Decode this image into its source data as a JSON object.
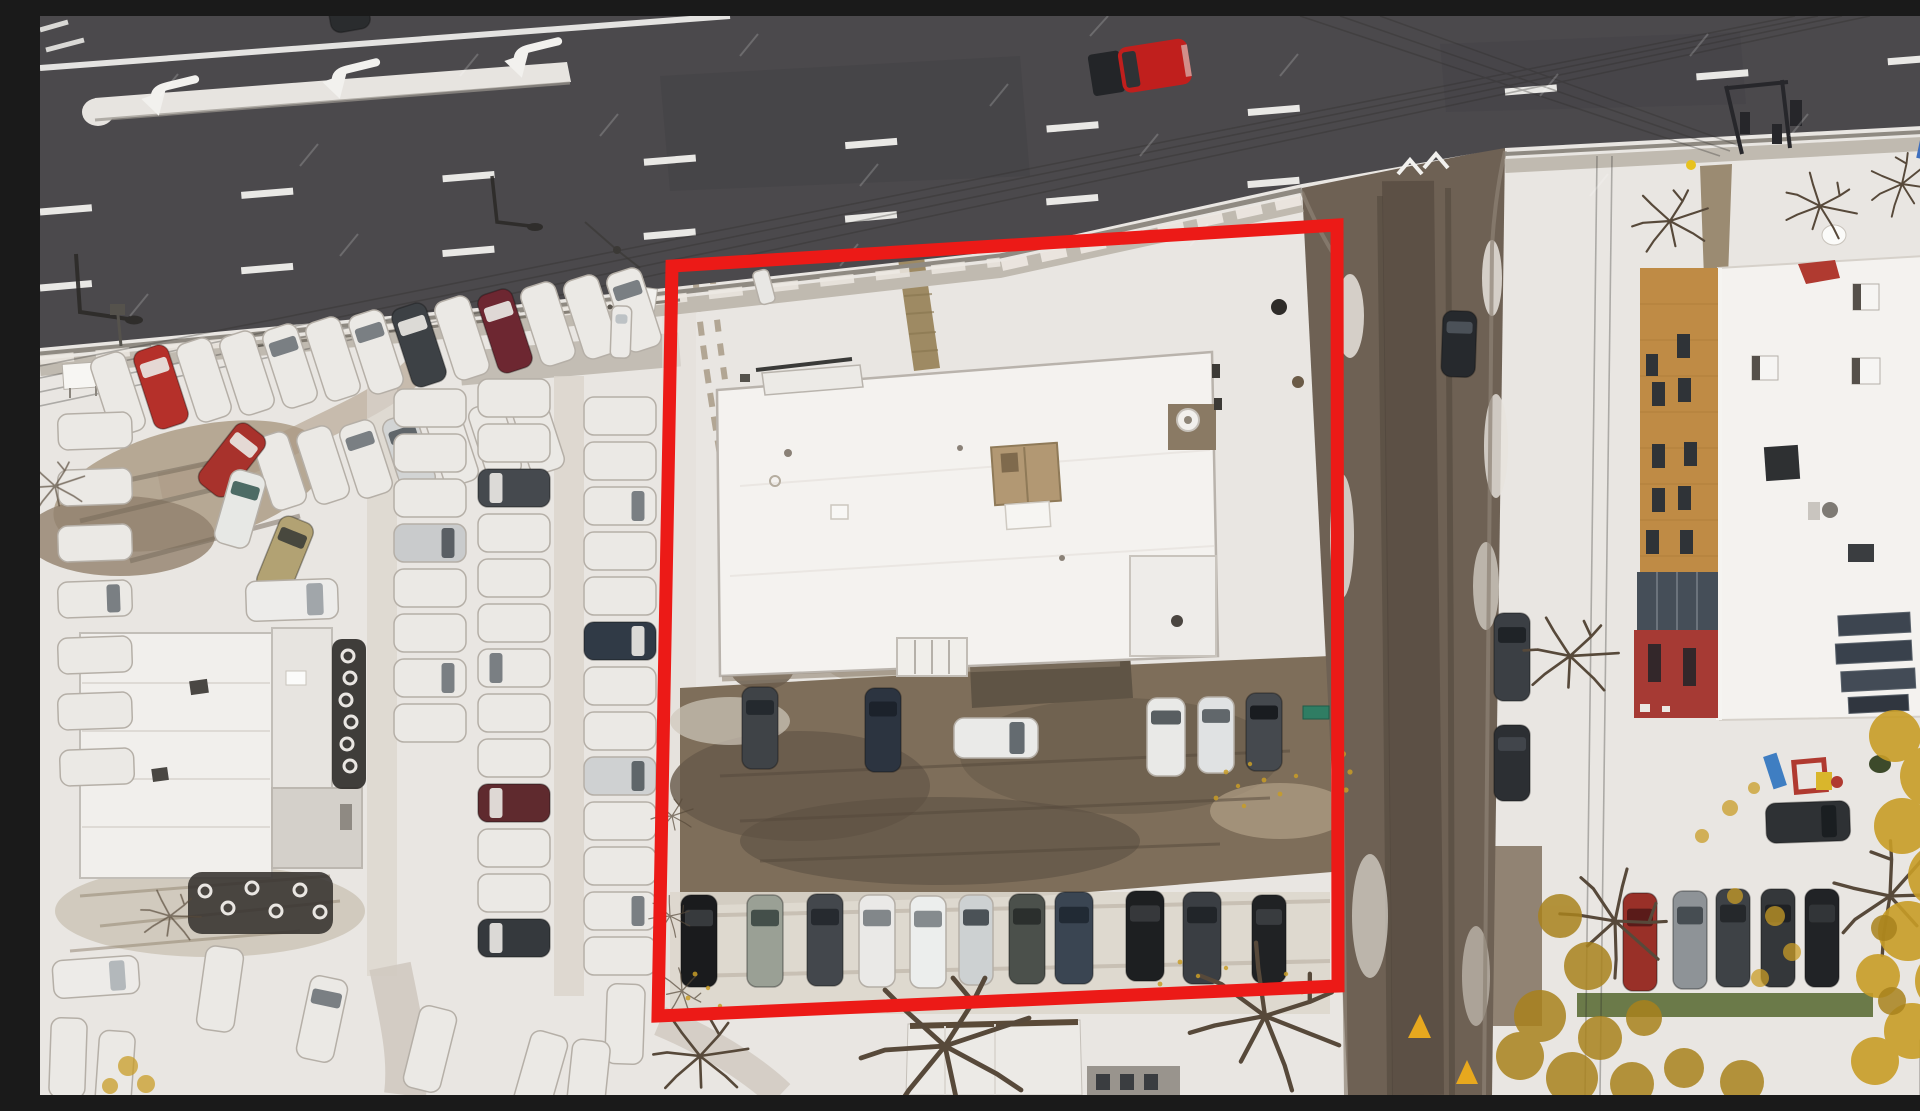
{
  "scene": {
    "description": "Aerial drone photograph, looking straight down, of a snow-dusted commercial parcel outlined with a thick red property boundary. A multi-lane road with white lane dashes and three left-turn arrows runs along the top, a wet brown side street runs down the right of the parcel, a car dealership lot full of snow-covered cars fills the left side, and an apartment building with a wooden and red facade, rooftop equipment and a small playground sits at the right. Autumn trees with yellow leaves surround the lower right.",
    "season": "early winter, fresh snow over autumn leaves",
    "camera": "top-down drone view"
  },
  "palette": {
    "snow": "#e9e6e2",
    "snow_bright": "#f4f2ee",
    "snow_trampled": "#cfc8bf",
    "sidewalk": "#c0bab0",
    "asphalt": "#4b494c",
    "asphalt_dark": "#434146",
    "side_road": "#6e6154",
    "wet_track": "#594e43",
    "mud": "#7e6e5a",
    "mud_dark": "#635647",
    "roof_snow": "#f4f2ef",
    "roof_line": "#b9b3ac",
    "left_roof": "#f1efec",
    "tan_unit": "#b29873",
    "tan_facade": "#bf8b45",
    "red_facade": "#a63a34",
    "glass": "#454e58",
    "boundary": "#ec1a17",
    "leaf": "#c89d27",
    "leaf_dark": "#a8821d",
    "grass": "#6b7a49",
    "tree": "#57493a",
    "line_white": "#f2f1ee",
    "car_snow": "#ebe9e5"
  },
  "boundary": {
    "purpose": "highlighted property parcel",
    "color": "#ec1a17",
    "stroke_width": 13,
    "corners": [
      [
        632,
        250
      ],
      [
        1297,
        209
      ],
      [
        1298,
        970
      ],
      [
        618,
        1000
      ]
    ]
  },
  "road_markings": {
    "turn_arrow_count": 3,
    "lane_dash_rows": 2,
    "give_way_chevrons": 2,
    "yellow_triangles": 2
  },
  "vehicles": {
    "count_estimate": 97,
    "note": "[cx, cy, rotation_deg, width, length, body_color, window_color] — SNOW = snow-covered car",
    "list": [
      [
        78,
        378,
        -18,
        36,
        82,
        "SNOW",
        ""
      ],
      [
        121,
        371,
        -18,
        36,
        82,
        "#b5302a",
        "#e9e7e3"
      ],
      [
        164,
        364,
        -18,
        36,
        82,
        "SNOW",
        ""
      ],
      [
        207,
        357,
        -18,
        36,
        82,
        "SNOW",
        ""
      ],
      [
        250,
        350,
        -18,
        36,
        82,
        "SNOW",
        "#70757b"
      ],
      [
        293,
        343,
        -18,
        36,
        82,
        "SNOW",
        ""
      ],
      [
        336,
        336,
        -18,
        36,
        82,
        "SNOW",
        "#70757b"
      ],
      [
        379,
        329,
        -18,
        36,
        82,
        "#3d4145",
        "#e9e7e3"
      ],
      [
        422,
        322,
        -18,
        36,
        82,
        "SNOW",
        ""
      ],
      [
        465,
        315,
        -18,
        36,
        82,
        "#6d2731",
        "#e9e7e3"
      ],
      [
        508,
        308,
        -18,
        36,
        82,
        "SNOW",
        ""
      ],
      [
        551,
        301,
        -18,
        36,
        82,
        "SNOW",
        ""
      ],
      [
        594,
        294,
        -18,
        36,
        82,
        "SNOW",
        "#70757b"
      ],
      [
        240,
        455,
        -18,
        36,
        76,
        "SNOW",
        ""
      ],
      [
        283,
        449,
        -18,
        36,
        76,
        "SNOW",
        ""
      ],
      [
        326,
        443,
        -18,
        36,
        76,
        "SNOW",
        "#70757b"
      ],
      [
        369,
        437,
        -18,
        36,
        76,
        "#d2d4d4",
        "#565c61"
      ],
      [
        412,
        431,
        -18,
        36,
        76,
        "SNOW",
        ""
      ],
      [
        455,
        425,
        -18,
        36,
        76,
        "SNOW",
        ""
      ],
      [
        498,
        419,
        -18,
        36,
        76,
        "SNOW",
        ""
      ],
      [
        55,
        415,
        88,
        36,
        74,
        "SNOW",
        ""
      ],
      [
        55,
        471,
        88,
        36,
        74,
        "SNOW",
        ""
      ],
      [
        55,
        527,
        88,
        36,
        74,
        "SNOW",
        ""
      ],
      [
        55,
        583,
        88,
        36,
        74,
        "SNOW",
        "#70757b"
      ],
      [
        55,
        639,
        88,
        36,
        74,
        "SNOW",
        ""
      ],
      [
        55,
        695,
        88,
        36,
        74,
        "SNOW",
        ""
      ],
      [
        57,
        751,
        88,
        36,
        74,
        "SNOW",
        ""
      ],
      [
        390,
        392,
        90,
        38,
        72,
        "SNOW",
        ""
      ],
      [
        390,
        437,
        90,
        38,
        72,
        "SNOW",
        ""
      ],
      [
        390,
        482,
        90,
        38,
        72,
        "SNOW",
        ""
      ],
      [
        390,
        527,
        90,
        38,
        72,
        "#c9cbcc",
        "#50565b"
      ],
      [
        390,
        572,
        90,
        38,
        72,
        "SNOW",
        ""
      ],
      [
        390,
        617,
        90,
        38,
        72,
        "SNOW",
        ""
      ],
      [
        390,
        662,
        90,
        38,
        72,
        "SNOW",
        "#70757b"
      ],
      [
        390,
        707,
        90,
        38,
        72,
        "SNOW",
        ""
      ],
      [
        474,
        382,
        -90,
        38,
        72,
        "SNOW",
        ""
      ],
      [
        474,
        427,
        -90,
        38,
        72,
        "SNOW",
        ""
      ],
      [
        474,
        472,
        -90,
        38,
        72,
        "#45494e",
        "#e9e7e3"
      ],
      [
        474,
        517,
        -90,
        38,
        72,
        "SNOW",
        ""
      ],
      [
        474,
        562,
        -90,
        38,
        72,
        "SNOW",
        ""
      ],
      [
        474,
        607,
        -90,
        38,
        72,
        "SNOW",
        ""
      ],
      [
        474,
        652,
        -90,
        38,
        72,
        "SNOW",
        "#70757b"
      ],
      [
        474,
        697,
        -90,
        38,
        72,
        "SNOW",
        ""
      ],
      [
        474,
        742,
        -90,
        38,
        72,
        "SNOW",
        ""
      ],
      [
        474,
        787,
        -90,
        38,
        72,
        "#5f2a2e",
        "#e9e7e3"
      ],
      [
        474,
        832,
        -90,
        38,
        72,
        "SNOW",
        ""
      ],
      [
        474,
        877,
        -90,
        38,
        72,
        "SNOW",
        ""
      ],
      [
        474,
        922,
        -90,
        38,
        72,
        "#35393d",
        "#e9e7e3"
      ],
      [
        580,
        400,
        90,
        38,
        72,
        "SNOW",
        ""
      ],
      [
        580,
        445,
        90,
        38,
        72,
        "SNOW",
        ""
      ],
      [
        580,
        490,
        90,
        38,
        72,
        "SNOW",
        "#70757b"
      ],
      [
        580,
        535,
        90,
        38,
        72,
        "SNOW",
        ""
      ],
      [
        580,
        580,
        90,
        38,
        72,
        "SNOW",
        ""
      ],
      [
        580,
        625,
        90,
        38,
        72,
        "#303a46",
        "#e9e7e3"
      ],
      [
        580,
        670,
        90,
        38,
        72,
        "SNOW",
        ""
      ],
      [
        580,
        715,
        90,
        38,
        72,
        "SNOW",
        ""
      ],
      [
        580,
        760,
        90,
        38,
        72,
        "#cfd1d2",
        "#565c61"
      ],
      [
        580,
        805,
        90,
        38,
        72,
        "SNOW",
        ""
      ],
      [
        580,
        850,
        90,
        38,
        72,
        "SNOW",
        ""
      ],
      [
        580,
        895,
        90,
        38,
        72,
        "SNOW",
        "#70757b"
      ],
      [
        580,
        940,
        90,
        38,
        72,
        "SNOW",
        ""
      ],
      [
        192,
        444,
        38,
        36,
        76,
        "#a8322c",
        "#e9e7e3"
      ],
      [
        200,
        493,
        16,
        36,
        76,
        "#e7e8e5",
        "#40605a"
      ],
      [
        245,
        540,
        22,
        36,
        78,
        "#b2a273",
        "#3f4039"
      ],
      [
        252,
        584,
        88,
        40,
        92,
        "#edecea",
        "#9aa0a4"
      ],
      [
        56,
        961,
        86,
        38,
        86,
        "#edebe8",
        "#aeb3b6"
      ],
      [
        180,
        973,
        8,
        38,
        84,
        "SNOW",
        ""
      ],
      [
        282,
        1003,
        12,
        38,
        84,
        "SNOW",
        "#70757b"
      ],
      [
        390,
        1033,
        14,
        38,
        84,
        "SNOW",
        ""
      ],
      [
        500,
        1058,
        16,
        38,
        84,
        "SNOW",
        ""
      ],
      [
        28,
        1042,
        2,
        36,
        80,
        "SNOW",
        ""
      ],
      [
        75,
        1055,
        4,
        36,
        80,
        "SNOW",
        ""
      ],
      [
        585,
        1008,
        2,
        38,
        80,
        "SNOW",
        ""
      ],
      [
        548,
        1064,
        6,
        38,
        80,
        "SNOW",
        ""
      ],
      [
        306,
        -20,
        -10,
        40,
        70,
        "#2a2c2e",
        "#17191b"
      ],
      [
        581,
        316,
        2,
        20,
        52,
        "#eceae7",
        "#b9bec2"
      ],
      [
        724,
        271,
        -15,
        16,
        34,
        "#e8e7e4",
        ""
      ],
      [
        720,
        712,
        0,
        36,
        82,
        "#3f4347",
        "#22272c"
      ],
      [
        843,
        714,
        0,
        36,
        84,
        "#2c3440",
        "#1b2129"
      ],
      [
        956,
        722,
        90,
        40,
        84,
        "#eaeae8",
        "#585f65"
      ],
      [
        1126,
        721,
        0,
        38,
        78,
        "#e9e9e7",
        "#4b5156"
      ],
      [
        1176,
        719,
        0,
        36,
        76,
        "#e0e2e3",
        "#565c61"
      ],
      [
        1224,
        716,
        0,
        36,
        78,
        "#45494e",
        "#16191c"
      ],
      [
        659,
        925,
        0,
        36,
        92,
        "#1a1b1d",
        "#3a3d40"
      ],
      [
        725,
        925,
        0,
        36,
        92,
        "#9aa095",
        "#3d4843"
      ],
      [
        785,
        924,
        0,
        36,
        92,
        "#43474c",
        "#24282c"
      ],
      [
        837,
        925,
        0,
        36,
        92,
        "#eae9e7",
        "#787e82"
      ],
      [
        888,
        926,
        0,
        36,
        92,
        "#eceeed",
        "#7c8285"
      ],
      [
        936,
        924,
        0,
        34,
        90,
        "#cdd1d2",
        "#40474c"
      ],
      [
        987,
        923,
        0,
        36,
        90,
        "#4b504b",
        "#282d2a"
      ],
      [
        1034,
        922,
        0,
        38,
        92,
        "#3a4552",
        "#202832"
      ],
      [
        1105,
        920,
        0,
        38,
        90,
        "#1d1f21",
        "#383b3e"
      ],
      [
        1162,
        922,
        0,
        38,
        92,
        "#3a3e43",
        "#1f2327"
      ],
      [
        1229,
        923,
        0,
        34,
        88,
        "#202224",
        "#3c3f42"
      ],
      [
        1419,
        328,
        2,
        34,
        66,
        "#26292d",
        "#4e555c"
      ],
      [
        1472,
        641,
        0,
        36,
        88,
        "#3b3f44",
        "#1d2125"
      ],
      [
        1472,
        747,
        0,
        36,
        76,
        "#2c2f33",
        "#43484d"
      ],
      [
        1768,
        806,
        88,
        40,
        84,
        "#2e3134",
        "#191c1f"
      ],
      [
        1600,
        926,
        0,
        34,
        98,
        "#993028",
        "#551a18"
      ],
      [
        1650,
        924,
        0,
        34,
        98,
        "#8e9397",
        "#40464c"
      ],
      [
        1693,
        922,
        0,
        34,
        98,
        "#3e4246",
        "#232629"
      ],
      [
        1738,
        922,
        0,
        34,
        98,
        "#34373a",
        "#1d2023"
      ],
      [
        1782,
        922,
        0,
        34,
        98,
        "#212326",
        "#343739"
      ],
      [
        1902,
        341,
        0,
        30,
        54,
        "#1e2124",
        "#111315"
      ]
    ]
  },
  "special_vehicles": {
    "red_pickup": {
      "location": "driving on main road, top centre",
      "body_color": "#c01f1d"
    }
  },
  "buildings": [
    {
      "name": "store-building",
      "roof": "flat, snow covered, tan rooftop unit, recessed vent court"
    },
    {
      "name": "dealership-service-building",
      "roof": "white flat roof with two dark vents"
    },
    {
      "name": "apartment-building",
      "facade": "wood tan upper, glass band, red lower",
      "roof": "snow with AC boxes and solar panels"
    },
    {
      "name": "house-bottom-centre",
      "roof": "white with dark eave line"
    }
  ],
  "landscape": {
    "ground": "fresh snow, muddy trampled parking areas",
    "foliage": "bare trees, yellow autumn leaves lower right",
    "playground": [
      "blue slide",
      "red-yellow climber"
    ]
  }
}
